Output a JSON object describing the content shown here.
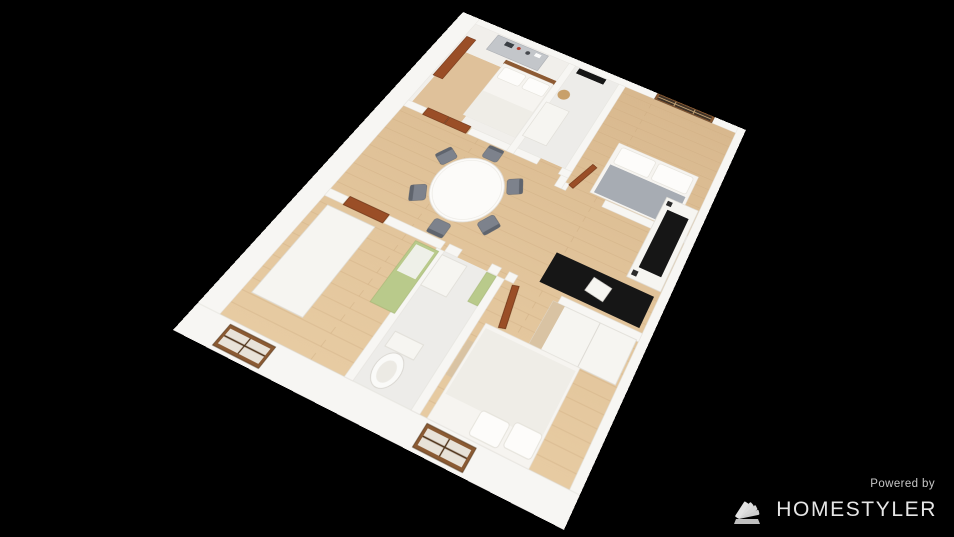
{
  "watermark": {
    "powered_by": "Powered by",
    "brand": "HOMESTYLER"
  },
  "palette": {
    "background": "#000000",
    "wall": "#f7f6f3",
    "wall_edge": "#e2dfda",
    "wood": "#dfc19a",
    "wood_line": "#c3a074",
    "floor_white": "#f1efeb",
    "floor_bath": "#edece9",
    "door": "#9a4e27",
    "door_edge": "#6e3517",
    "window_frame": "#8a5a33",
    "window_pane_dark": "#3f3226",
    "window_pane_light": "#e8e2d8",
    "window_grid": "#4f3319",
    "window_grid_light": "#c9a97a",
    "chair": "#7d828c",
    "chair_edge": "#5f646d",
    "table": "#fcfbf9",
    "black": "#161616",
    "dresser": "#c3c6ca",
    "bed_white": "#f6f4f0",
    "pillow_edge": "#e2dfd8",
    "blanket_gray": "#a7acb3",
    "blanket_white": "#efede7",
    "green": "#b9ca8b",
    "tan": "#c8a06a",
    "toilet_edge": "#d5d2cc",
    "watermark_text": "#e6e6e6",
    "watermark_sub": "#c8c8c8",
    "logo": "#cfcfcf"
  }
}
